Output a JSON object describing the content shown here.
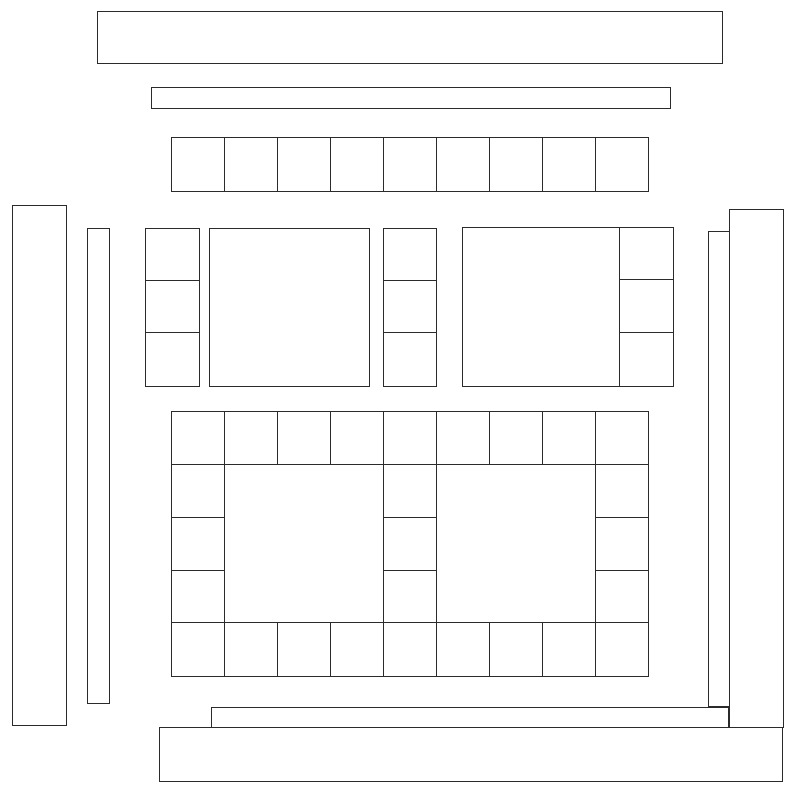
{
  "canvas": {
    "width": 801,
    "height": 793,
    "background_color": "#ffffff",
    "stroke_color": "#2b2b2b",
    "stroke_width": 1
  },
  "diagram": {
    "kind": "wireframe-rectangle-assembly-diagram",
    "rects": [
      {
        "name": "top-outer-border-strip",
        "x": 97,
        "y": 11,
        "w": 626,
        "h": 53
      },
      {
        "name": "top-inner-border-strip",
        "x": 151,
        "y": 87,
        "w": 520,
        "h": 22
      },
      {
        "name": "left-outer-border-strip",
        "x": 12,
        "y": 205,
        "w": 55,
        "h": 521
      },
      {
        "name": "left-inner-border-strip",
        "x": 87,
        "y": 228,
        "w": 23,
        "h": 476
      },
      {
        "name": "right-inner-border-strip",
        "x": 708,
        "y": 231,
        "w": 22,
        "h": 476
      },
      {
        "name": "right-outer-border-strip",
        "x": 729,
        "y": 209,
        "w": 55,
        "h": 519
      },
      {
        "name": "bottom-inner-border-strip",
        "x": 211,
        "y": 707,
        "w": 518,
        "h": 21
      },
      {
        "name": "bottom-outer-border-strip",
        "x": 159,
        "y": 727,
        "w": 624,
        "h": 55
      },
      {
        "name": "middle-left-large-block",
        "x": 209,
        "y": 228,
        "w": 161,
        "h": 159
      },
      {
        "name": "middle-right-large-block",
        "x": 462,
        "y": 227,
        "w": 158,
        "h": 160
      }
    ],
    "cell_groups": [
      {
        "name": "top-cornerstone-row",
        "x_edges": [
          171,
          224,
          277,
          330,
          383,
          436,
          489,
          542,
          595,
          648
        ],
        "y_edges": [
          137,
          191
        ]
      },
      {
        "name": "middle-left-sash-column",
        "x_edges": [
          145,
          199
        ],
        "y_edges": [
          228,
          280,
          332,
          386
        ]
      },
      {
        "name": "middle-center-sash-column",
        "x_edges": [
          383,
          436
        ],
        "y_edges": [
          228,
          280,
          332,
          386
        ]
      },
      {
        "name": "middle-right-sash-column",
        "x_edges": [
          619,
          673
        ],
        "y_edges": [
          227,
          279,
          332,
          386
        ]
      },
      {
        "name": "lower-grid-top-row",
        "x_edges": [
          171,
          224,
          277,
          330,
          383,
          436,
          489,
          542,
          595,
          648
        ],
        "y_edges": [
          411,
          464
        ]
      },
      {
        "name": "lower-grid-bottom-row",
        "x_edges": [
          171,
          224,
          277,
          330,
          383,
          436,
          489,
          542,
          595,
          648
        ],
        "y_edges": [
          622,
          676
        ]
      },
      {
        "name": "lower-grid-left-column",
        "x_edges": [
          171,
          224
        ],
        "y_edges": [
          464,
          517,
          570,
          622
        ]
      },
      {
        "name": "lower-grid-center-column",
        "x_edges": [
          383,
          436
        ],
        "y_edges": [
          464,
          517,
          570,
          622
        ]
      },
      {
        "name": "lower-grid-right-column",
        "x_edges": [
          595,
          648
        ],
        "y_edges": [
          464,
          517,
          570,
          622
        ]
      }
    ]
  }
}
